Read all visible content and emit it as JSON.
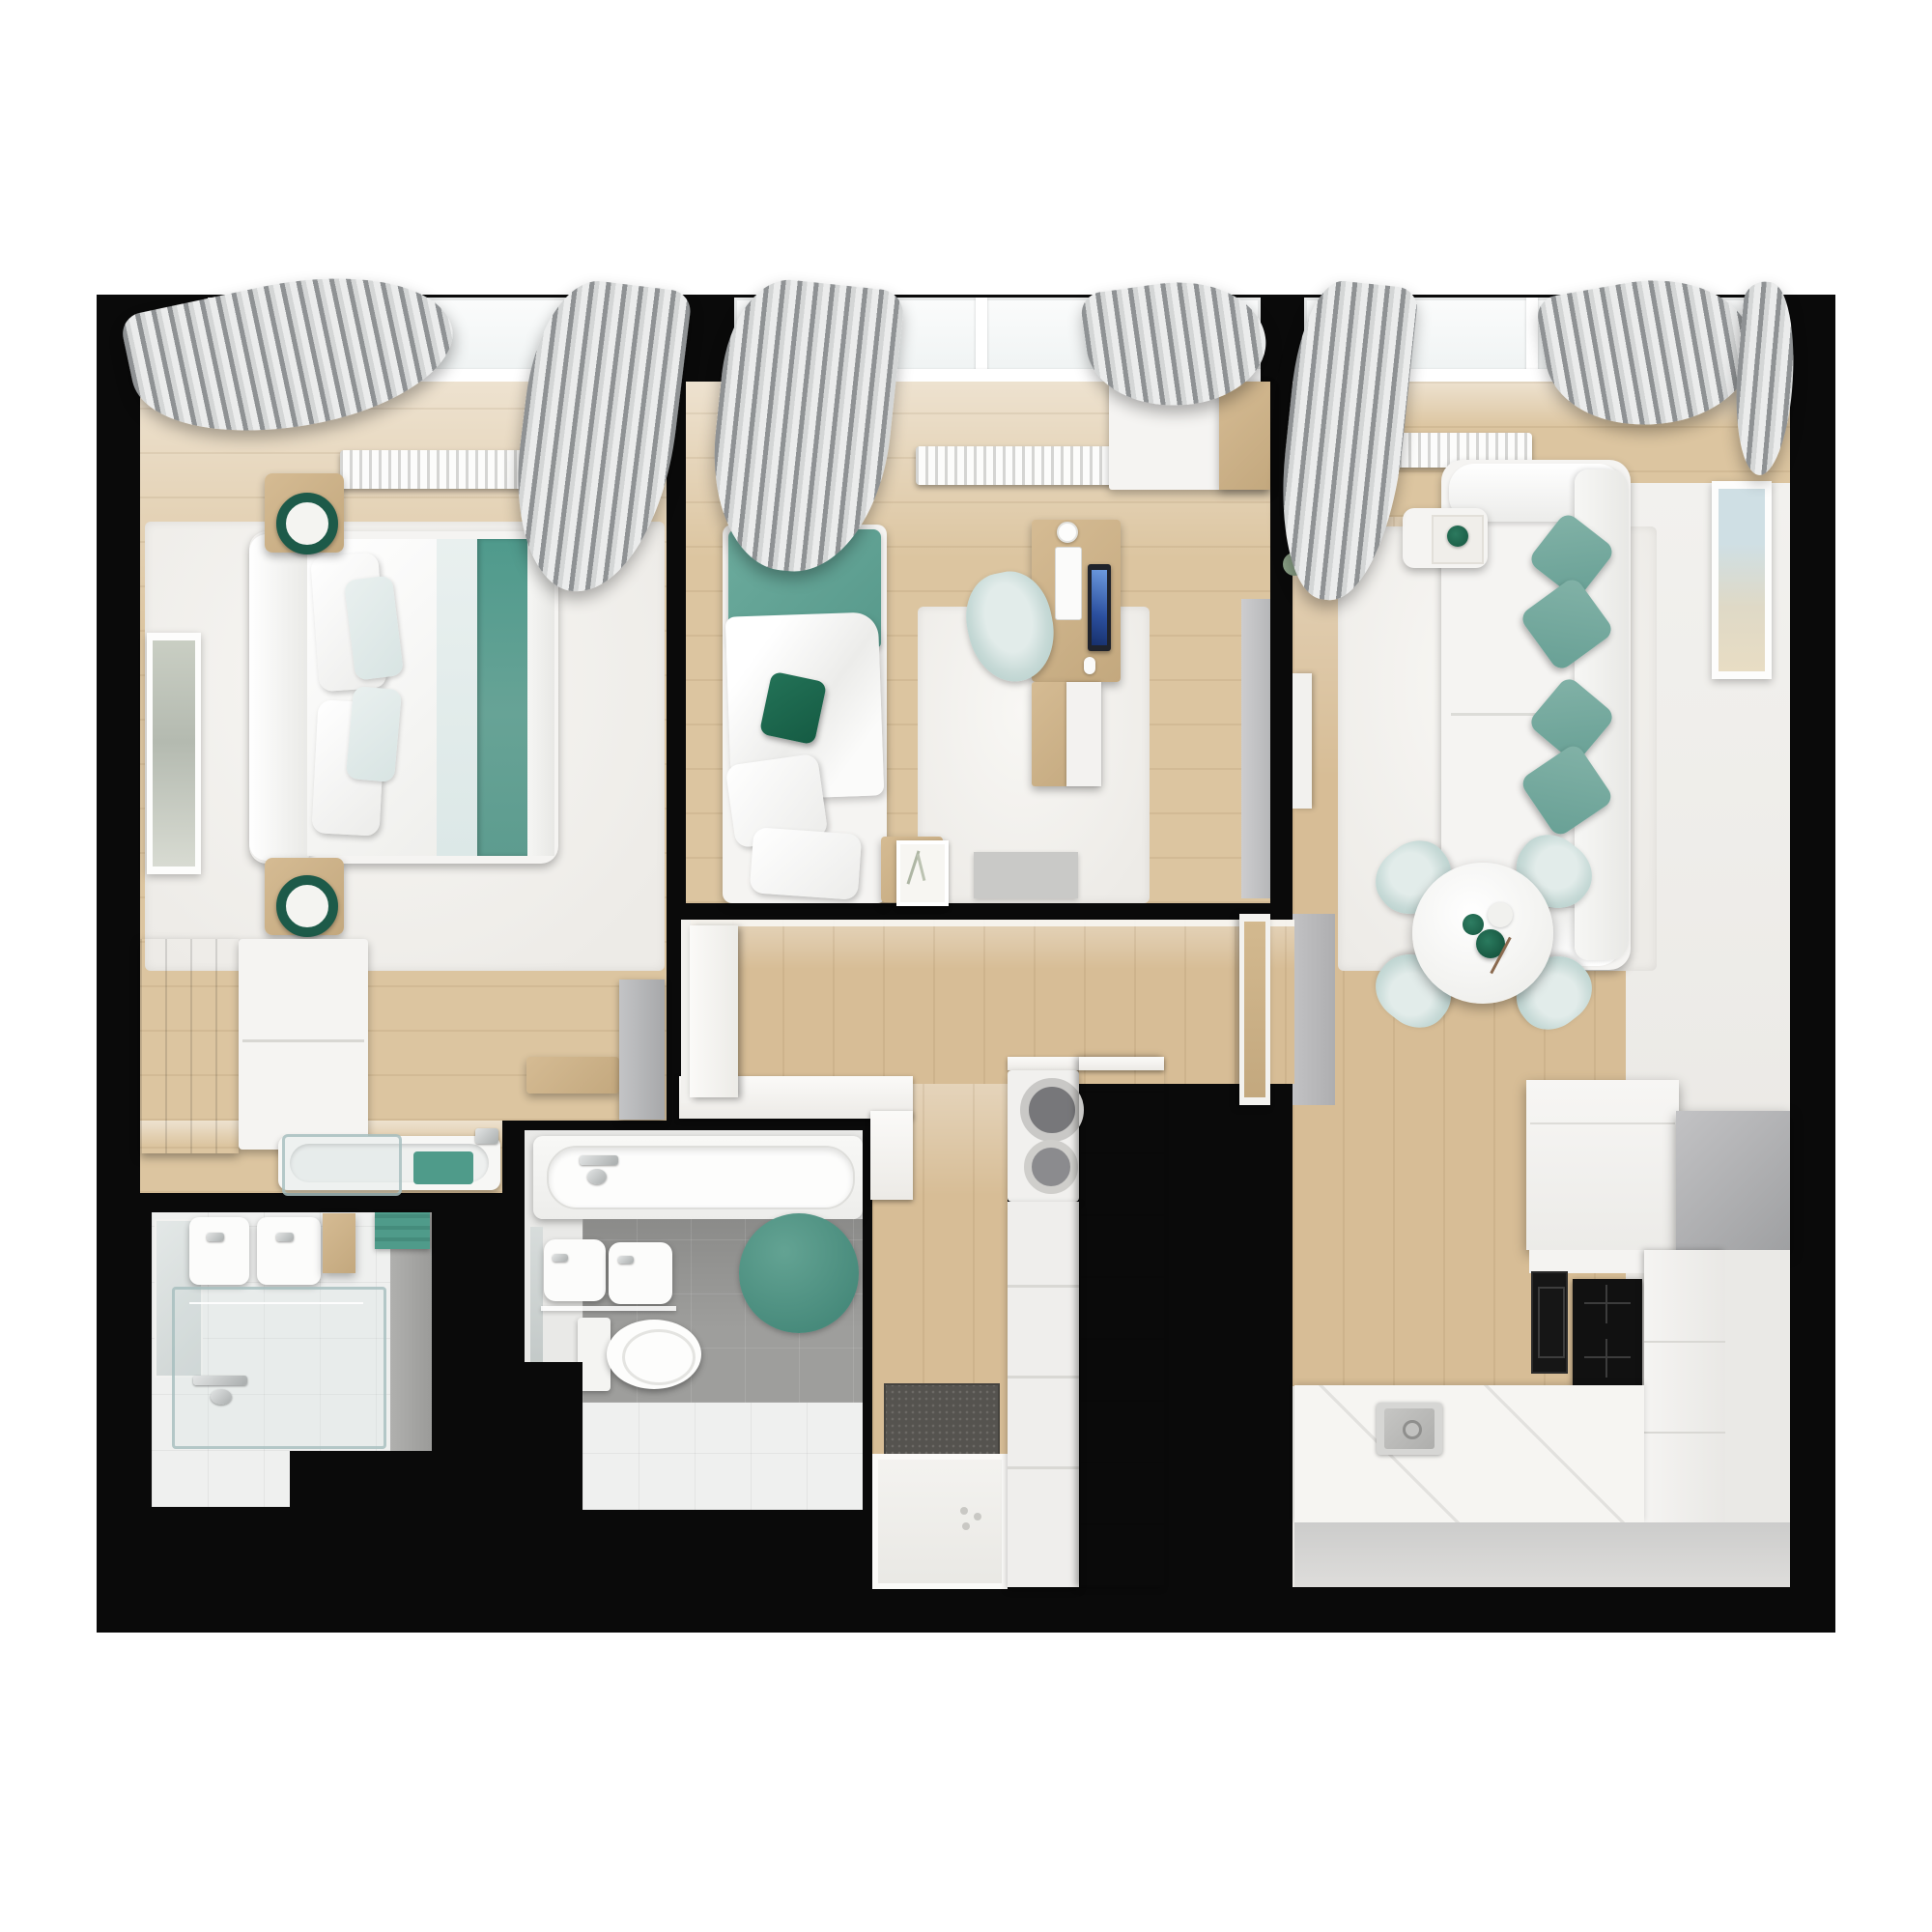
{
  "scene": {
    "type": "3d-rendered apartment floor plan, top-down view",
    "palette": {
      "background": "#ffffff",
      "walls": "#0a0a0a",
      "wood_floor": "#d9c29c",
      "light_wood_floor": "#e6d5b5",
      "furniture_wood": "#cdb38a",
      "dark_wood": "#8a6f54",
      "white_furniture": "#f5f4f2",
      "accent_teal": "#74a89d",
      "accent_teal_dark": "#1d6e53",
      "pale_blue": "#c7dad7",
      "curtain_gray": "#9b9ea0",
      "bathroom_tile_gray": "#9e9e9c",
      "doormat_gray": "#595755",
      "appliance_black": "#151515",
      "metal_gray": "#b3b3b5"
    },
    "rooms": [
      {
        "id": "master-bedroom",
        "label": "master bedroom",
        "items": [
          "double-bed",
          "white-and-teal-bedding",
          "two-nightstands",
          "two-teal-table-lamps",
          "dark-wood-wardrobe",
          "white-dresser",
          "wall-art",
          "wall-shelf",
          "gray-panel",
          "open-bathtub-nook",
          "window-with-curtains",
          "radiator",
          "white-rug"
        ]
      },
      {
        "id": "second-bedroom",
        "label": "second bedroom",
        "items": [
          "single-bed-teal-blanket",
          "green-pillow",
          "desk",
          "computer-monitor",
          "keyboard",
          "office-chair",
          "wardrobe",
          "storage-cabinet",
          "side-table-with-frame",
          "white-rug",
          "window-with-curtains",
          "radiator"
        ]
      },
      {
        "id": "living-room-kitchen",
        "label": "living room and kitchen",
        "items": [
          "white-sofa",
          "four-teal-cushions",
          "side-table-with-cup",
          "wall-art",
          "round-dining-table",
          "four-pale-blue-chairs",
          "green-vases",
          "plant",
          "gray-tv-strip",
          "white-sideboard",
          "gray-appliance-block",
          "oven",
          "induction-cooktop",
          "tall-cabinets",
          "counter-with-sink",
          "window-with-curtains",
          "radiator"
        ]
      },
      {
        "id": "hallway",
        "label": "hallway and entry",
        "items": [
          "wood-floor",
          "doormat",
          "white-entry-floor",
          "washing-machine-column",
          "wood-storage-column",
          "open-door-to-master-bedroom",
          "open-door-to-living-room"
        ]
      },
      {
        "id": "bathroom-1",
        "label": "en-suite bathroom",
        "items": [
          "double-wall-sinks",
          "mirror",
          "glass-shower",
          "wall-faucet",
          "wood-cabinet",
          "teal-towel"
        ]
      },
      {
        "id": "bathroom-2",
        "label": "main bathroom",
        "items": [
          "bathtub",
          "wall-faucet",
          "double-wall-sinks",
          "toilet",
          "teal-round-rug",
          "gray-tile-floor"
        ]
      }
    ]
  }
}
